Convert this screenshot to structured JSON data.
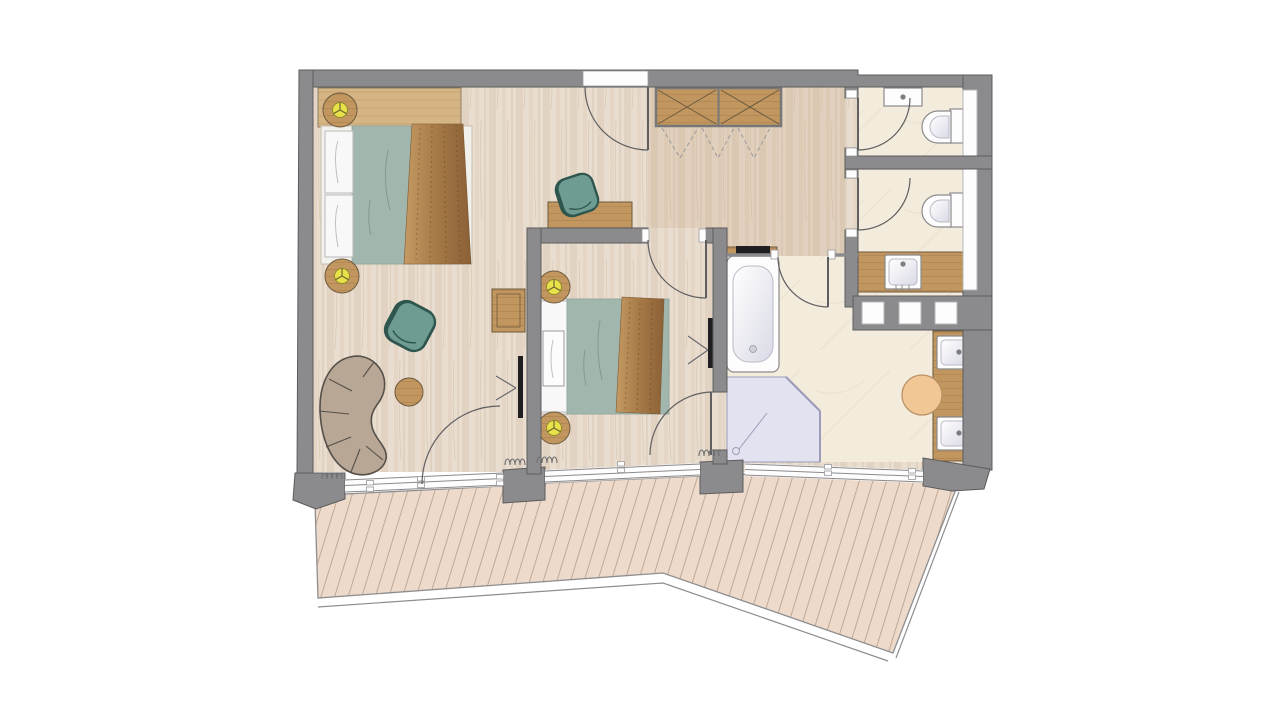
{
  "page": {
    "type": "architectural-floor-plan",
    "description": "Top-down floor plan of a two-bedroom hotel suite with terrace",
    "background": "#ffffff"
  },
  "colors": {
    "background": "#ffffff",
    "wall": "#8b8b8d",
    "wallStroke": "#5c5c5e",
    "floorBase": "#e9ddcf",
    "floorGrain": "#d8c6b1",
    "floorLine": "#c6b29a",
    "hallTint": "#c9ab89",
    "tile": "#f3ecdd",
    "tileVein": "#e3d8c3",
    "deckBase": "#eddaca",
    "deckLine": "#b59c87",
    "deckEdge": "#8e8e90",
    "duvet": "#a1b7ae",
    "duvetFold": "#84988e",
    "pillow": "#f8f8f9",
    "runnerLight": "#c59a63",
    "runnerDark": "#8a6036",
    "woodFurniture": "#c2965f",
    "woodGrainDark": "#a07744",
    "consoleWood": "#d6b585",
    "furnitureOutline": "#6d5a3e",
    "teal": "#6f9c92",
    "tealDark": "#2e564e",
    "sofa": "#b8a795",
    "sofaOutline": "#55504a",
    "lamp": "#e9e14b",
    "lampOutline": "#8f8a2a",
    "white": "#fdfdfe",
    "fixtureStroke": "#8a8a8c",
    "shower": "#e2e2f0",
    "showerStroke": "#9c9cb8",
    "stool": "#f0c795",
    "stoolStroke": "#bb9266",
    "tv": "#1f1f21",
    "glassLine": "#8a8a8c",
    "doorArc": "#5f5f61",
    "radiator": "#6f6f71"
  },
  "rooms": [
    {
      "id": "bedroom-1",
      "name": "master bedroom"
    },
    {
      "id": "bedroom-2",
      "name": "second bedroom"
    },
    {
      "id": "living-area",
      "name": "living area"
    },
    {
      "id": "entry-hall",
      "name": "entry hall with wardrobe"
    },
    {
      "id": "bathroom",
      "name": "main bathroom"
    },
    {
      "id": "wc-1",
      "name": "toilet room 1"
    },
    {
      "id": "wc-2",
      "name": "toilet room 2 with washbasin"
    },
    {
      "id": "terrace",
      "name": "wooden deck terrace"
    }
  ],
  "furniture": {
    "bedroom_1": [
      "double-bed",
      "two-pillows",
      "bed-runner",
      "nightstand-with-lamp",
      "nightstand-with-lamp",
      "wall-console",
      "desk",
      "desk-chair"
    ],
    "bedroom_2": [
      "double-bed",
      "pillow",
      "bed-runner",
      "nightstand-with-lamp",
      "nightstand-with-lamp",
      "wall-tv"
    ],
    "living_area": [
      "curved-sofa",
      "round-coffee-table",
      "armchair",
      "side-bench",
      "wall-tv"
    ],
    "entry_hall": [
      "built-in-wardrobe",
      "hanging-clothes"
    ],
    "bathroom": [
      "bathtub",
      "walk-in-shower",
      "double-vanity",
      "stool",
      "towel-niches"
    ],
    "wc_1": [
      "toilet",
      "small-sink"
    ],
    "wc_2": [
      "toilet",
      "washbasin-counter"
    ]
  }
}
